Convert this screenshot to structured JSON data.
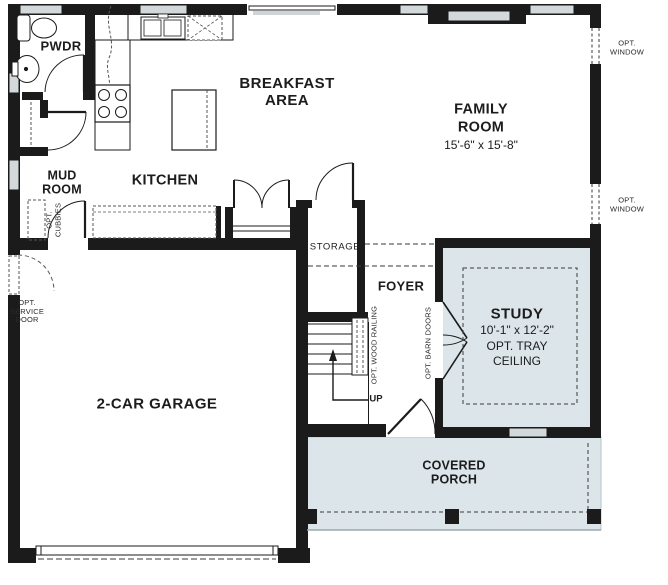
{
  "meta": {
    "type": "residential floor plan",
    "floor": "first floor"
  },
  "colors": {
    "wall": "#1b1b1b",
    "optional_room_fill": "#dce6ea",
    "window_fill": "#d3d8da",
    "dash": "#3a3a3a",
    "background": "#ffffff"
  },
  "rooms": {
    "powder": {
      "label": "PWDR"
    },
    "mud_room": {
      "line1": "MUD",
      "line2": "ROOM"
    },
    "kitchen": {
      "label": "KITCHEN"
    },
    "breakfast": {
      "line1": "BREAKFAST",
      "line2": "AREA"
    },
    "family_room": {
      "line1": "FAMILY",
      "line2": "ROOM",
      "dims": "15'-6\" x 15'-8\""
    },
    "storage": {
      "label": "STORAGE"
    },
    "foyer": {
      "label": "FOYER"
    },
    "study": {
      "label": "STUDY",
      "dims": "10'-1\" x 12'-2\"",
      "opt_line1": "OPT. TRAY",
      "opt_line2": "CEILING"
    },
    "garage": {
      "label": "2-CAR GARAGE"
    },
    "porch": {
      "line1": "COVERED",
      "line2": "PORCH"
    }
  },
  "annotations": {
    "opt_window_upper": {
      "line1": "OPT.",
      "line2": "WINDOW"
    },
    "opt_window_lower": {
      "line1": "OPT.",
      "line2": "WINDOW"
    },
    "opt_cubbies": {
      "line1": "OPT.",
      "line2": "CUBBIES"
    },
    "opt_service_door": {
      "line1": "OPT.",
      "line2": "SERVICE",
      "line3": "DOOR"
    },
    "opt_wood_railing": "OPT. WOOD RAILING",
    "opt_barn_doors": "OPT. BARN DOORS",
    "stairs_up": "UP"
  }
}
